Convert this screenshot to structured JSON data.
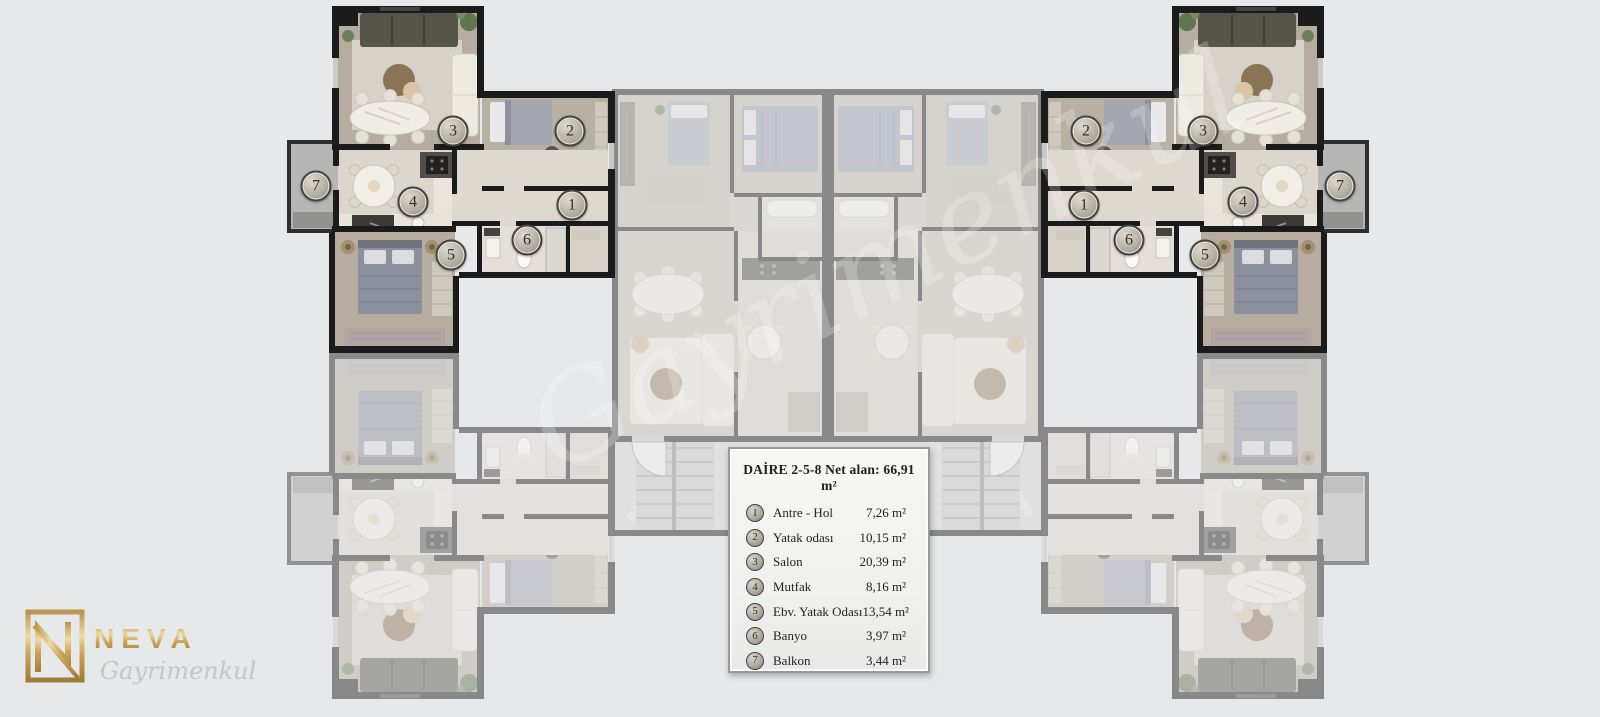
{
  "colors": {
    "background": "#e7e8e9",
    "wall": "#1b1b1b",
    "logo_gold": "#c9a45c",
    "legend_border": "#9a9a98"
  },
  "plan": {
    "markers": {
      "left": [
        "1",
        "2",
        "3",
        "4",
        "5",
        "6",
        "7"
      ],
      "right": [
        "1",
        "2",
        "3",
        "4",
        "5",
        "6",
        "7"
      ]
    }
  },
  "legend": {
    "title": "DAİRE 2-5-8 Net alan: 66,91 m²",
    "items": [
      {
        "num": "1",
        "label": "Antre - Hol",
        "area": "7,26 m²"
      },
      {
        "num": "2",
        "label": "Yatak odası",
        "area": "10,15 m²"
      },
      {
        "num": "3",
        "label": "Salon",
        "area": "20,39 m²"
      },
      {
        "num": "4",
        "label": "Mutfak",
        "area": "8,16 m²"
      },
      {
        "num": "5",
        "label": "Ebv. Yatak Odası",
        "area": "13,54 m²"
      },
      {
        "num": "6",
        "label": "Banyo",
        "area": "3,97 m²"
      },
      {
        "num": "7",
        "label": "Balkon",
        "area": "3,44 m²"
      }
    ]
  },
  "logo": {
    "name": "NEVA",
    "subtitle": "Gayrimenkul"
  }
}
